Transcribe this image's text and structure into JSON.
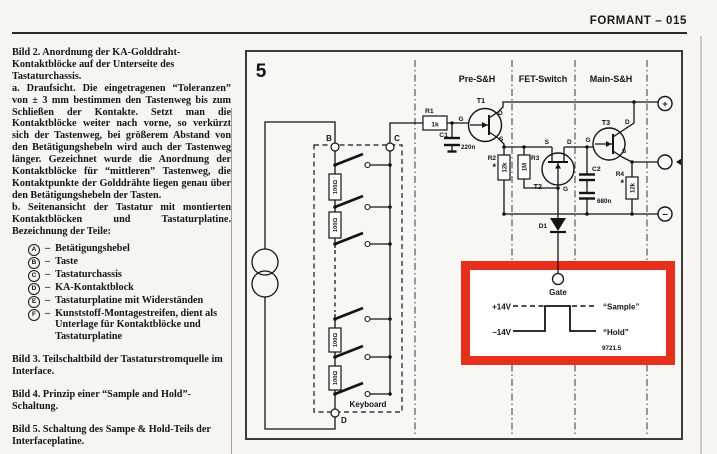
{
  "page": {
    "header": {
      "title": "FORMANT – 015"
    },
    "left_column": {
      "bild2_caption": "Bild 2. Anordnung der KA-Golddraht-Kontaktblöcke auf der Unterseite des Tastaturchassis.",
      "para_a": "a. Draufsicht. Die eingetragenen “Toleranzen” von ± 3 mm bestimmen den Tastenweg bis zum Schließen der Kontakte. Setzt man die Kontaktblöcke weiter nach vorne, so verkürzt sich der Tastenweg, bei größerem Abstand von den Betätigungshebeln wird auch der Tastenweg länger. Gezeichnet wurde die Anordnung der Kontaktblöcke für “mittleren” Tastenweg, die Kontaktpunkte der Golddrähte liegen genau über den Betätigungshebeln der Tasten.",
      "para_b": "b. Seitenansicht der Tastatur mit montierten Kontaktblöcken und Tastaturplatine. Bezeichnung der Teile:",
      "legend_separator": "–",
      "legend": [
        {
          "key": "A",
          "label": "Betätigungshebel"
        },
        {
          "key": "B",
          "label": "Taste"
        },
        {
          "key": "C",
          "label": "Tastaturchassis"
        },
        {
          "key": "D",
          "label": "KA-Kontaktblock"
        },
        {
          "key": "E",
          "label": "Tastaturplatine mit Widerständen"
        },
        {
          "key": "F",
          "label": "Kunststoff-Montagestreifen, dient als Unterlage für Kontaktblöcke und Tastaturplatine"
        }
      ],
      "bild3_caption": "Bild 3. Teilschaltbild der Tastaturstromquelle im Interface.",
      "bild4_caption": "Bild 4. Prinzip einer “Sample and Hold”-Schaltung.",
      "bild5_caption": "Bild 5. Schaltung des Sampe & Hold-Teils der Interfaceplatine."
    },
    "figure": {
      "number": "5",
      "section_labels": {
        "pre": "Pre-S&H",
        "fet": "FET-Switch",
        "main": "Main-S&H"
      },
      "keyboard_label": "Keyboard",
      "nodes": {
        "b": "B",
        "c": "C",
        "d": "D"
      },
      "components": {
        "r1": {
          "name": "R1",
          "value": "1k"
        },
        "c1": {
          "name": "C1",
          "value": "220n"
        },
        "r2": {
          "name": "R2",
          "value": "12k",
          "note": "*"
        },
        "r3": {
          "name": "R3",
          "value": "1M"
        },
        "r4": {
          "name": "R4",
          "value": "12k",
          "note": "*"
        },
        "c2": {
          "name": "C2",
          "value": "680n"
        },
        "t1": {
          "name": "T1"
        },
        "t2": {
          "name": "T2"
        },
        "t3": {
          "name": "T3"
        },
        "d1": {
          "name": "D1"
        },
        "r_key": {
          "value": "100Ω"
        }
      },
      "pins": {
        "g": "G",
        "d": "D",
        "s": "S"
      },
      "terminals": {
        "plus": "+",
        "minus": "−"
      },
      "highlight": {
        "color": "#e6301d",
        "gate_label": "Gate",
        "level_high": "+14V",
        "level_low": "–14V",
        "sample_label": "“Sample”",
        "hold_label": "“Hold”",
        "ref_number": "9721.5"
      }
    }
  }
}
